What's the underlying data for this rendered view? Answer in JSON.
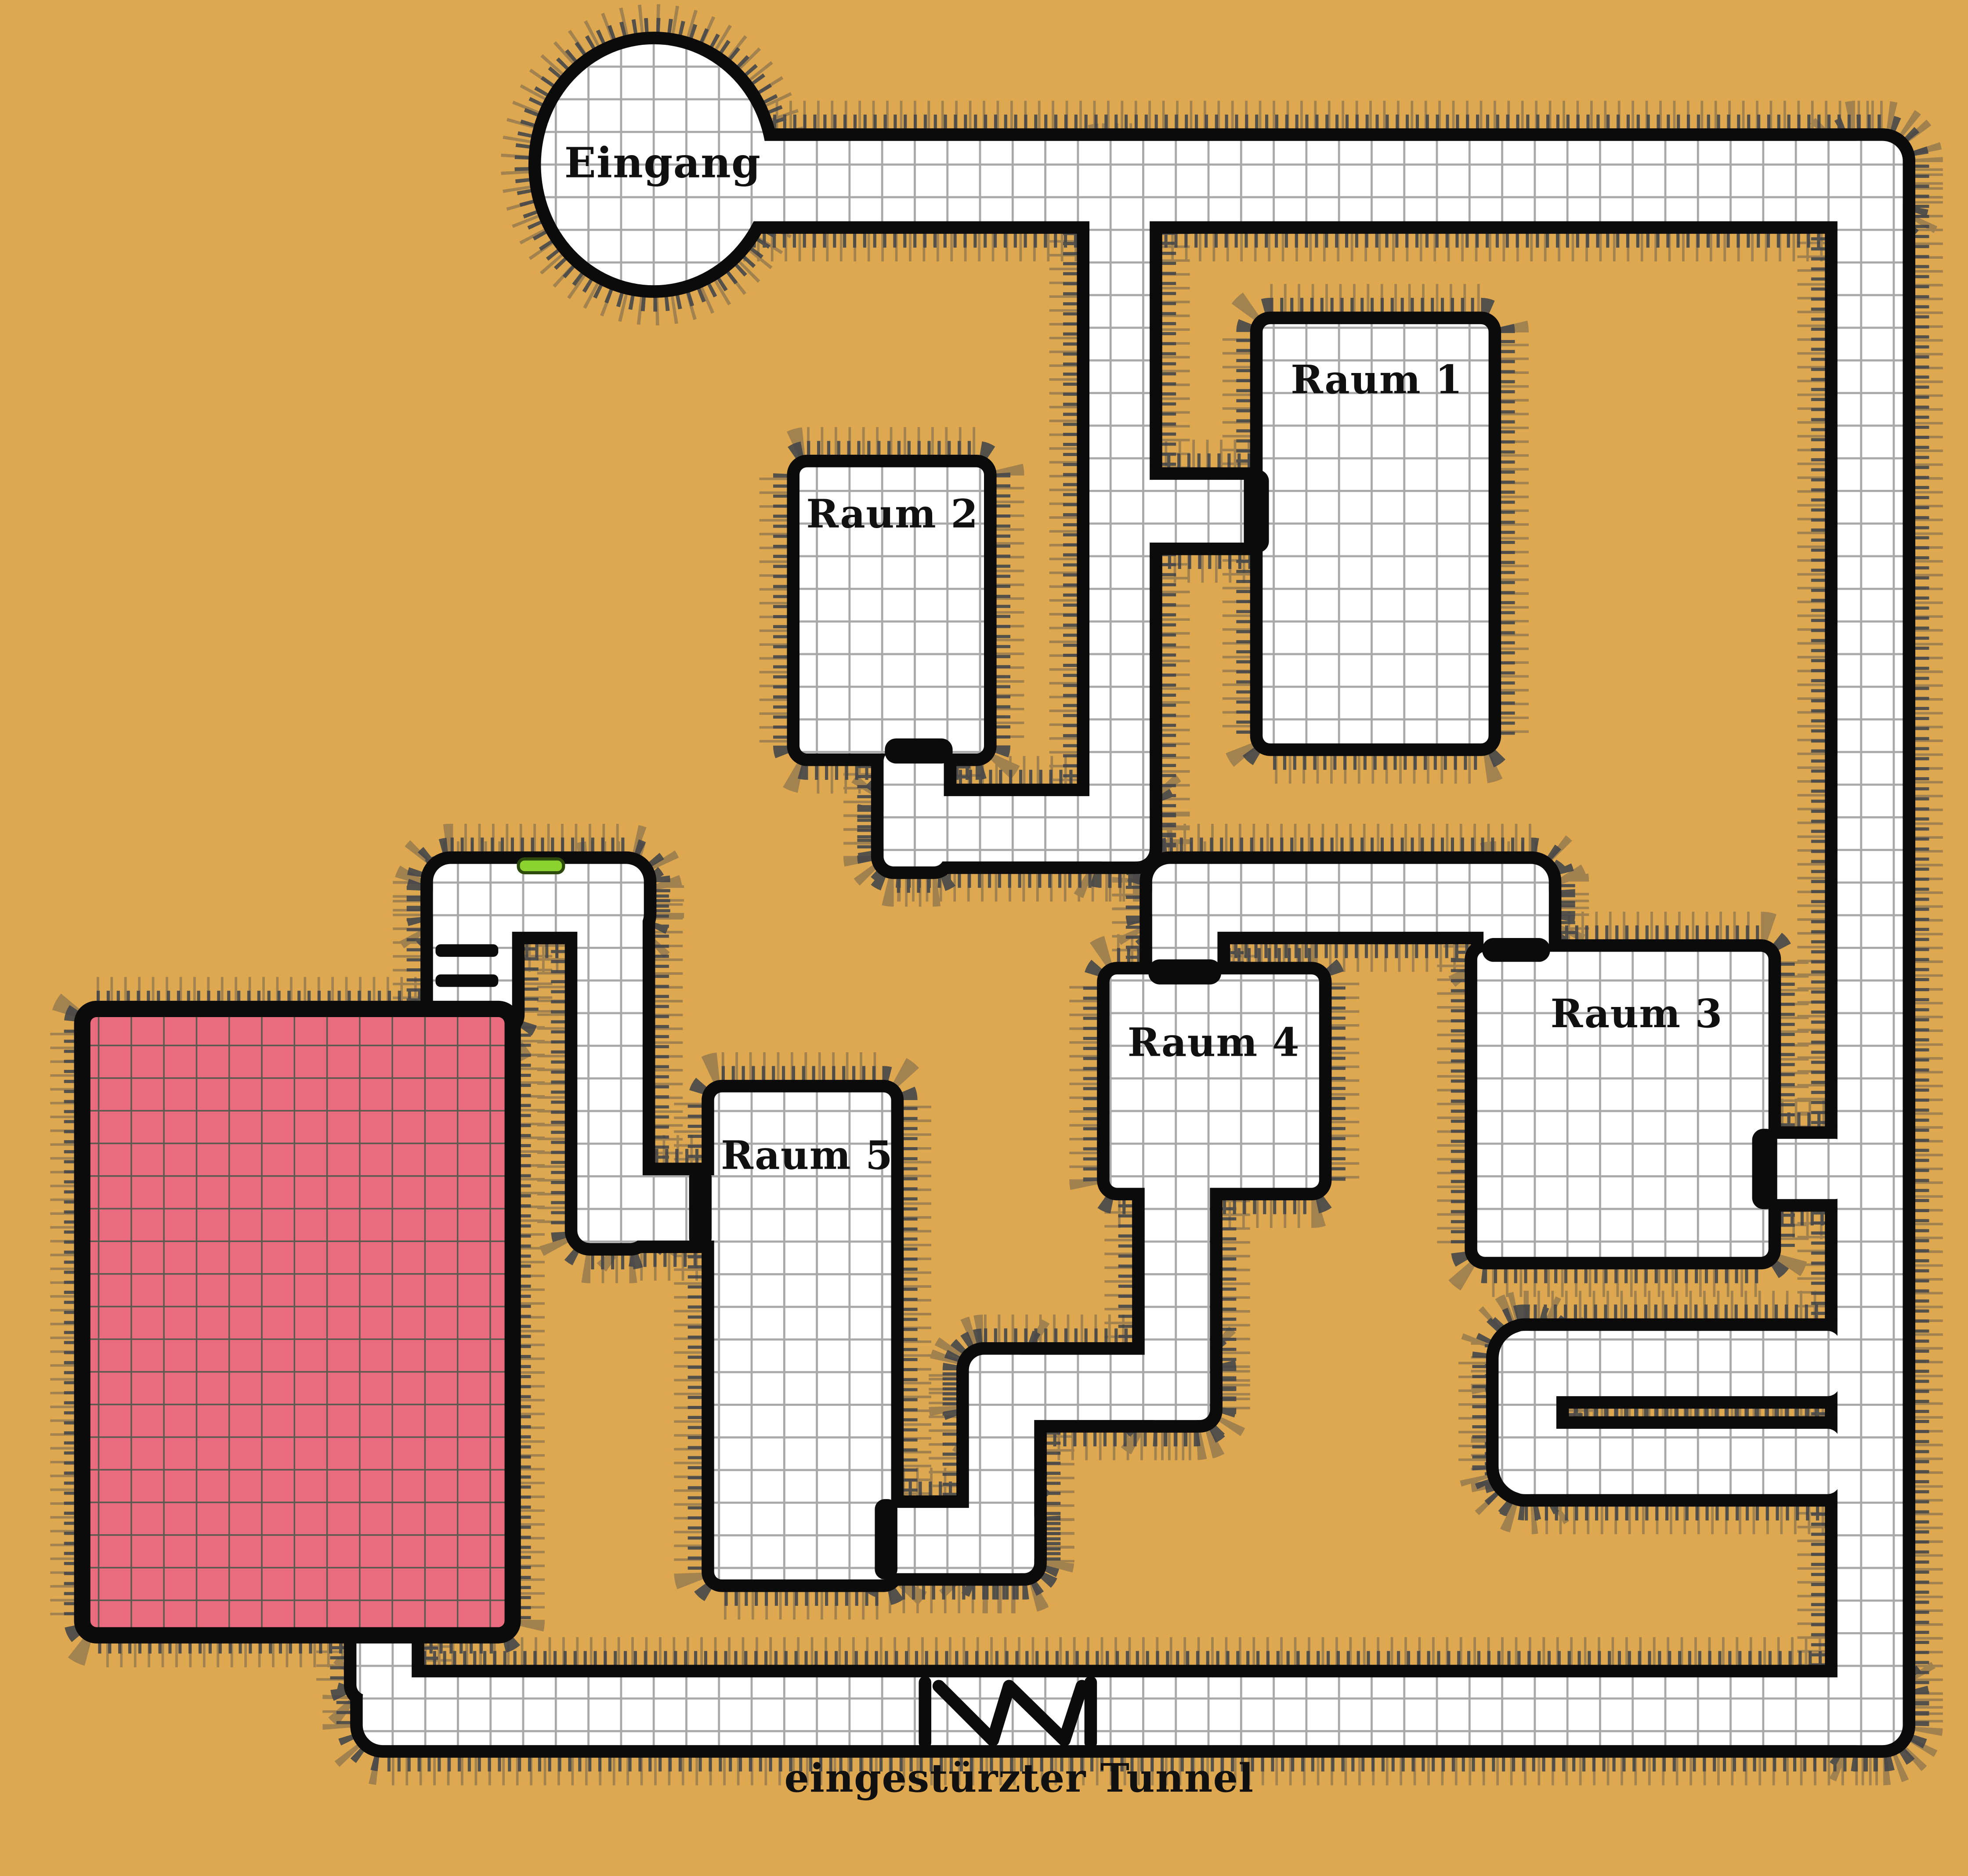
{
  "labels": {
    "entrance": "Eingang",
    "room1": "Raum 1",
    "room2": "Raum 2",
    "room3": "Raum 3",
    "room4": "Raum 4",
    "room5": "Raum 5",
    "collapsed_tunnel": "eingestürzter Tunnel"
  },
  "markers": {
    "collapsed_tunnel": "zigzag-barrier-icon",
    "stairs": "stairs-icon",
    "green_slime": "green-slime-marker-icon"
  },
  "colors": {
    "background": "#dea851",
    "floor_white": "#ffffff",
    "grid_line": "#a9a9a9",
    "wall": "#0b0b0b",
    "room_red": "#ea6b7d",
    "room_red_grid": "#5a5a50",
    "hatch": "#41444a",
    "marker_green": "#8dd32f"
  }
}
